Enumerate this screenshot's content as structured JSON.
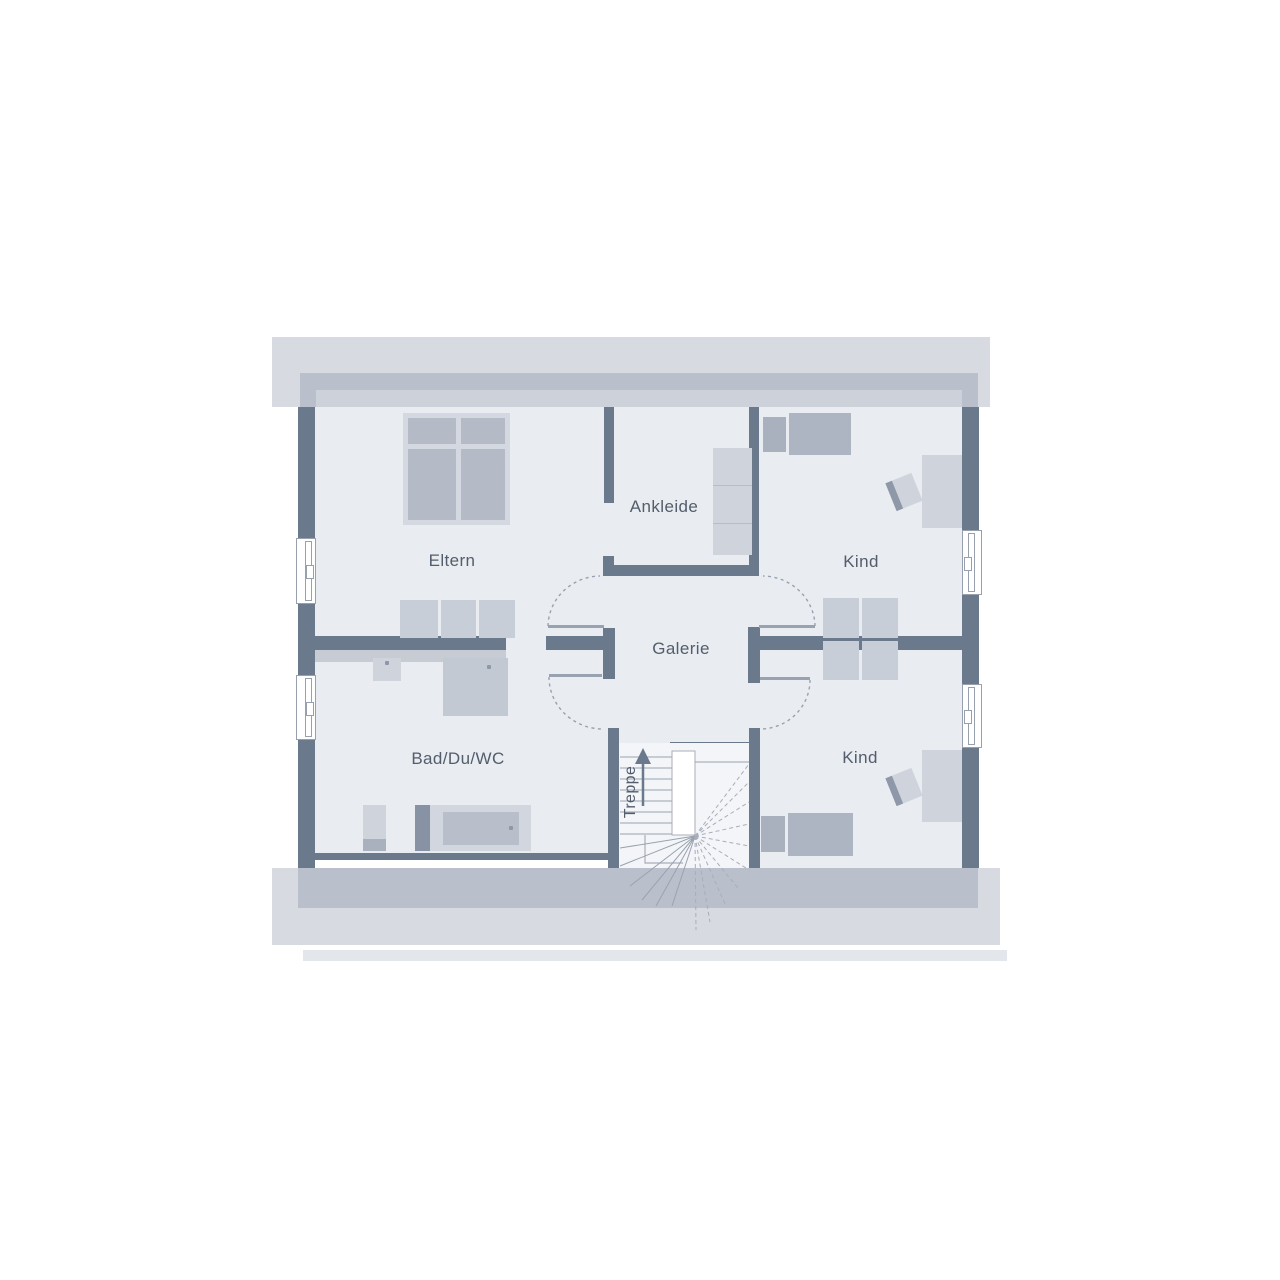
{
  "plan": {
    "type": "floor-plan-upper-storey",
    "labels": {
      "eltern": "Eltern",
      "ankleide": "Ankleide",
      "kind_top": "Kind",
      "galerie": "Galerie",
      "bad": "Bad/Du/WC",
      "kind_bottom": "Kind",
      "treppe": "Treppe"
    },
    "colors": {
      "wall": "#6b798c",
      "floor": "#e9ecf1",
      "roof_band_light": "#d7dae1",
      "roof_band_medium": "#bac0cb",
      "roof_band_strip": "#cdd2da",
      "furniture_light": "#cfd4dc",
      "furniture_medium": "#b4bbc7",
      "furniture_dark": "#a9b1bf",
      "line": "#98a1af",
      "text": "#535d6b"
    }
  }
}
